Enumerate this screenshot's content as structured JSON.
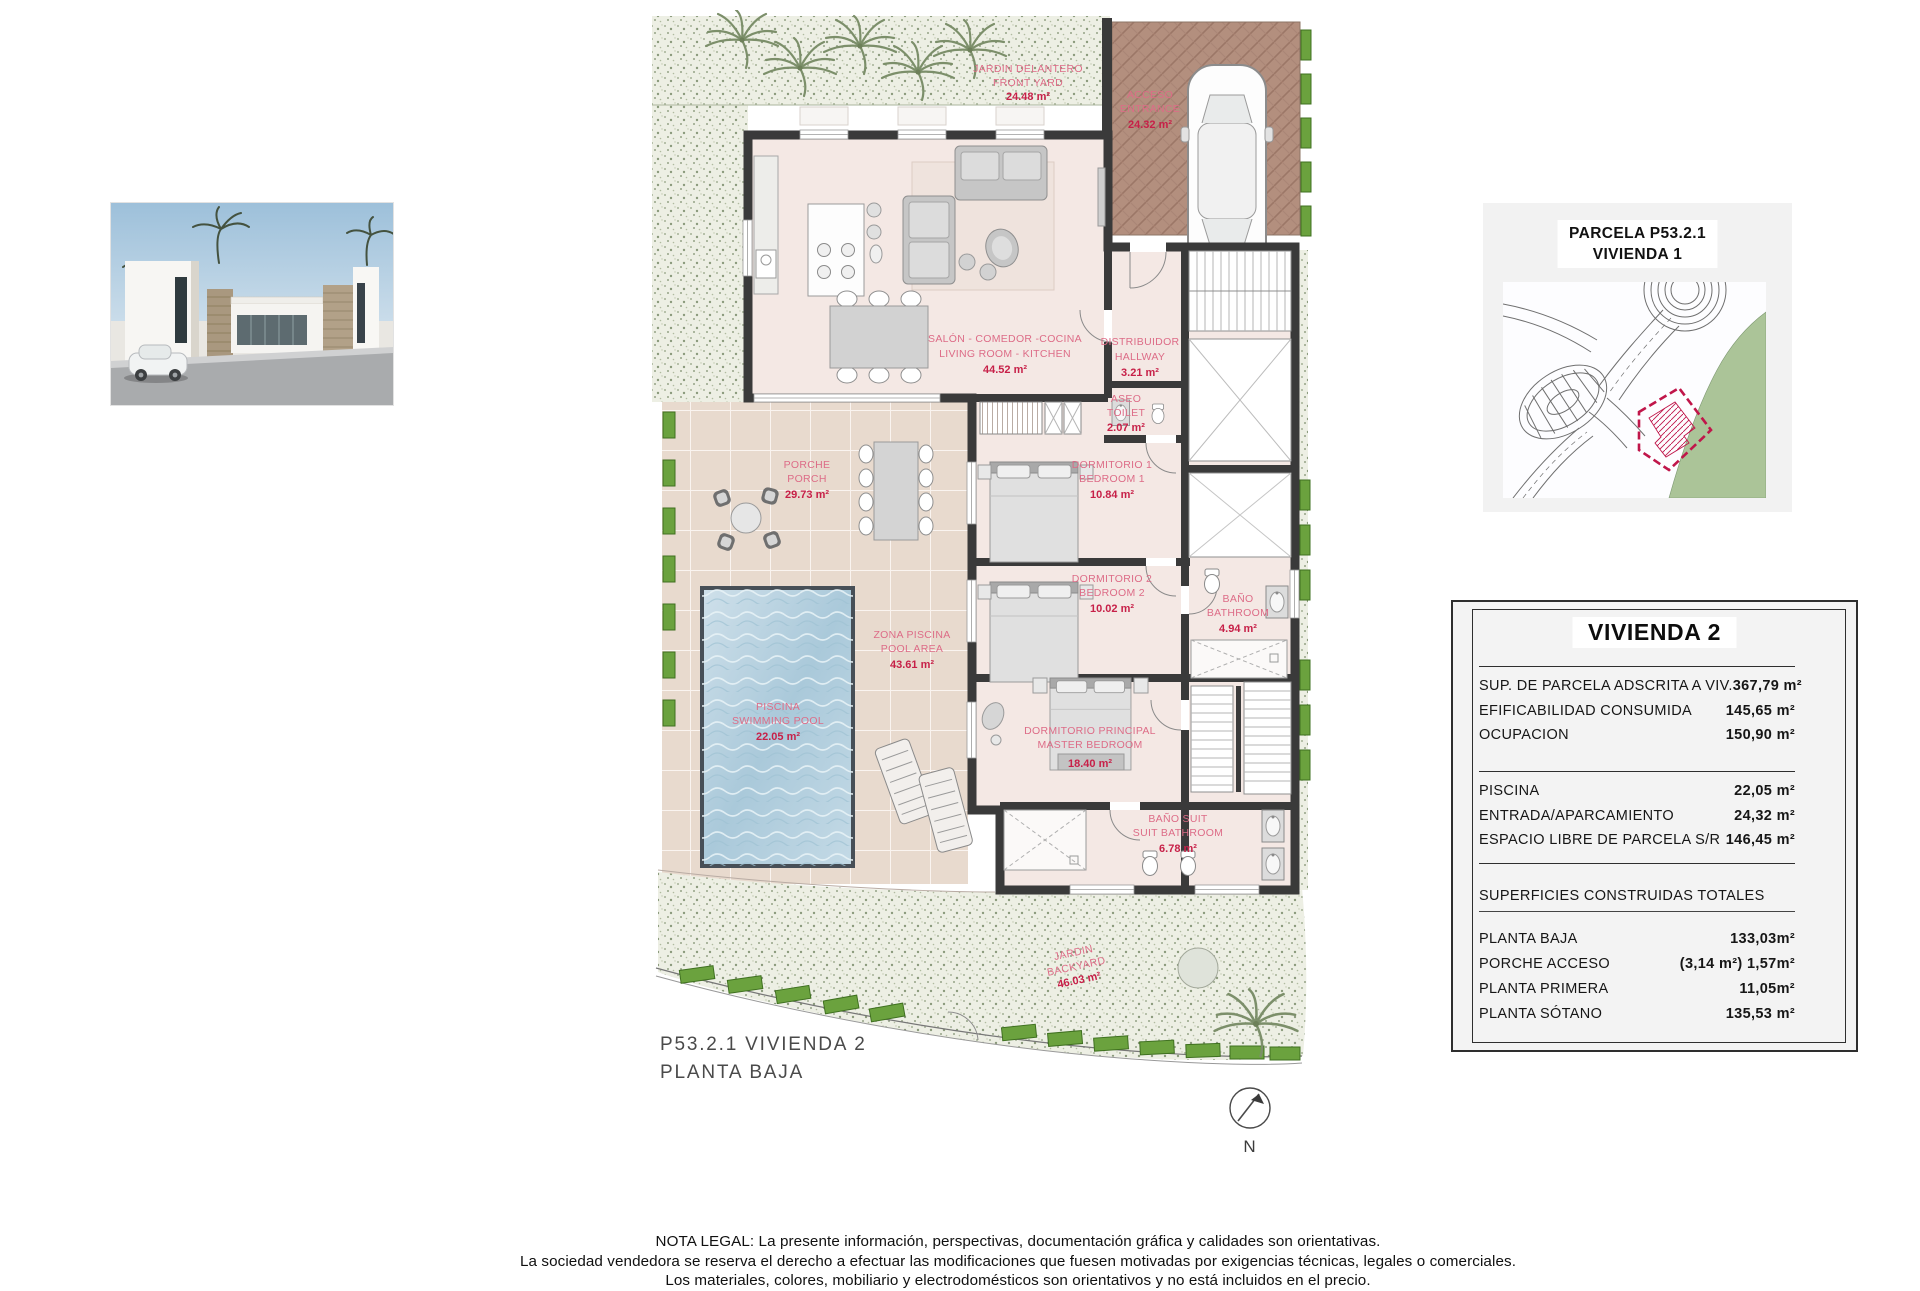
{
  "colors": {
    "wall": "#3a3a3a",
    "label_pink": "#dd6c87",
    "value_red": "#c72048",
    "hedge_green": "#6ba23e",
    "garden": "#edefe4",
    "tiles": "#e8dace",
    "driveway": "#b38f7e",
    "pool_blue": "#aac9da",
    "map_green": "#abc498",
    "parcel_red": "#c0164a",
    "panel_gray": "#f3f3f3"
  },
  "plan": {
    "caption_line1": "P53.2.1 VIVIENDA 2",
    "caption_line2": "PLANTA BAJA",
    "north_label": "N",
    "rooms": [
      {
        "id": "front_yard",
        "lines": [
          "JARDIN DELANTERO",
          "FRONT YARD",
          "24.48 m²"
        ]
      },
      {
        "id": "access",
        "lines": [
          "ACCESO",
          "ENTRANCE",
          "24.32 m²"
        ]
      },
      {
        "id": "living",
        "lines": [
          "SALÓN - COMEDOR -COCINA",
          "LIVING ROOM - KITCHEN",
          "44.52 m²"
        ]
      },
      {
        "id": "hallway",
        "lines": [
          "DISTRIBUIDOR",
          "HALLWAY",
          "3.21 m²"
        ]
      },
      {
        "id": "toilet",
        "lines": [
          "ASEO",
          "TOILET",
          "2.07 m²"
        ]
      },
      {
        "id": "bedroom1",
        "lines": [
          "DORMITORIO 1",
          "BEDROOM 1",
          "10.84 m²"
        ]
      },
      {
        "id": "bedroom2",
        "lines": [
          "DORMITORIO 2",
          "BEDROOM 2",
          "10.02 m²"
        ]
      },
      {
        "id": "bathroom",
        "lines": [
          "BAÑO",
          "BATHROOM",
          "4.94 m²"
        ]
      },
      {
        "id": "porch",
        "lines": [
          "PORCHE",
          "PORCH",
          "29.73 m²"
        ]
      },
      {
        "id": "pool_area",
        "lines": [
          "ZONA PISCINA",
          "POOL AREA",
          "43.61 m²"
        ]
      },
      {
        "id": "pool",
        "lines": [
          "PISCINA",
          "SWIMMING POOL",
          "22.05 m²"
        ]
      },
      {
        "id": "master",
        "lines": [
          "DORMITORIO PRINCIPAL",
          "MASTER BEDROOM",
          "18.40 m²"
        ]
      },
      {
        "id": "suit_bathroom",
        "lines": [
          "BAÑO SUIT",
          "SUIT BATHROOM",
          "6.78 m²"
        ]
      },
      {
        "id": "backyard",
        "lines": [
          "JARDIN",
          "BACKYARD",
          "46.03 m²"
        ]
      }
    ]
  },
  "site_panel": {
    "title_line1": "PARCELA P53.2.1",
    "title_line2": "VIVIENDA 1"
  },
  "spec_table": {
    "title": "VIVIENDA 2",
    "rows_top": [
      {
        "label": "SUP. DE PARCELA ADSCRITA A VIV.",
        "value": "367,79 m²"
      },
      {
        "label": "EFIFICABILIDAD CONSUMIDA",
        "value": "145,65 m²"
      },
      {
        "label": "OCUPACION",
        "value": "150,90 m²"
      }
    ],
    "rows_mid": [
      {
        "label": "PISCINA",
        "value": "22,05 m²"
      },
      {
        "label": "ENTRADA/APARCAMIENTO",
        "value": "24,32 m²"
      },
      {
        "label": "ESPACIO LIBRE DE PARCELA S/R",
        "value": "146,45 m²"
      }
    ],
    "section_title": "SUPERFICIES CONSTRUIDAS TOTALES",
    "rows_bottom": [
      {
        "label": "PLANTA BAJA",
        "value": "133,03m²"
      },
      {
        "label": "PORCHE ACCESO",
        "value": "(3,14 m²) 1,57m²"
      },
      {
        "label": "PLANTA PRIMERA",
        "value": "11,05m²"
      },
      {
        "label": "PLANTA SÓTANO",
        "value": "135,53 m²"
      }
    ]
  },
  "legal": {
    "line1": "NOTA LEGAL: La presente información, perspectivas, documentación gráfica y calidades son orientativas.",
    "line2": "La sociedad vendedora se reserva el derecho a efectuar las modificaciones que fuesen motivadas por exigencias técnicas, legales o comerciales.",
    "line3": "Los materiales, colores, mobiliario y electrodomésticos son orientativos y no está incluidos en el precio."
  }
}
